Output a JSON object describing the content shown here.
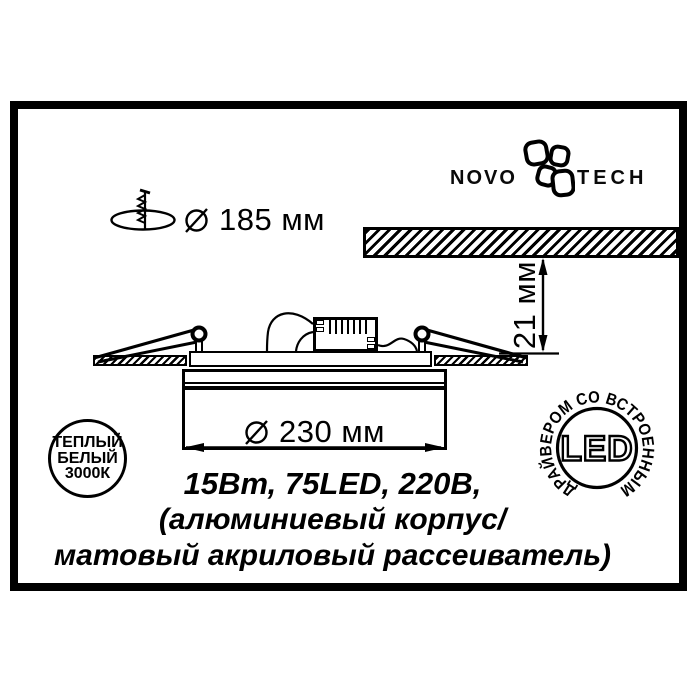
{
  "brand": {
    "logo_left": "NOVO",
    "logo_right": "TECH"
  },
  "dims": {
    "cutout": {
      "symbol": "⌀",
      "value": "185 мм"
    },
    "depth": "21 мм",
    "overall": {
      "symbol": "⌀",
      "value": "230 мм"
    }
  },
  "specs": [
    "15Вт, 75LED, 220В,",
    "(алюминиевый корпус/",
    "матовый акриловый рассеиватель)"
  ],
  "badges": {
    "warm_white": [
      "ТЕПЛЫЙ",
      "БЕЛЫЙ",
      "3000К"
    ],
    "led": {
      "label": "LED",
      "ring": "ДРАЙВЕРОМ СО ВСТРОЕННЫМ"
    }
  },
  "icons": {
    "flower": "novotech-flower-logo",
    "cutout": "cutout-hole-with-screw-icon",
    "diameter": "diameter-symbol"
  },
  "colors": {
    "ink": "#000000",
    "paper": "#ffffff"
  }
}
